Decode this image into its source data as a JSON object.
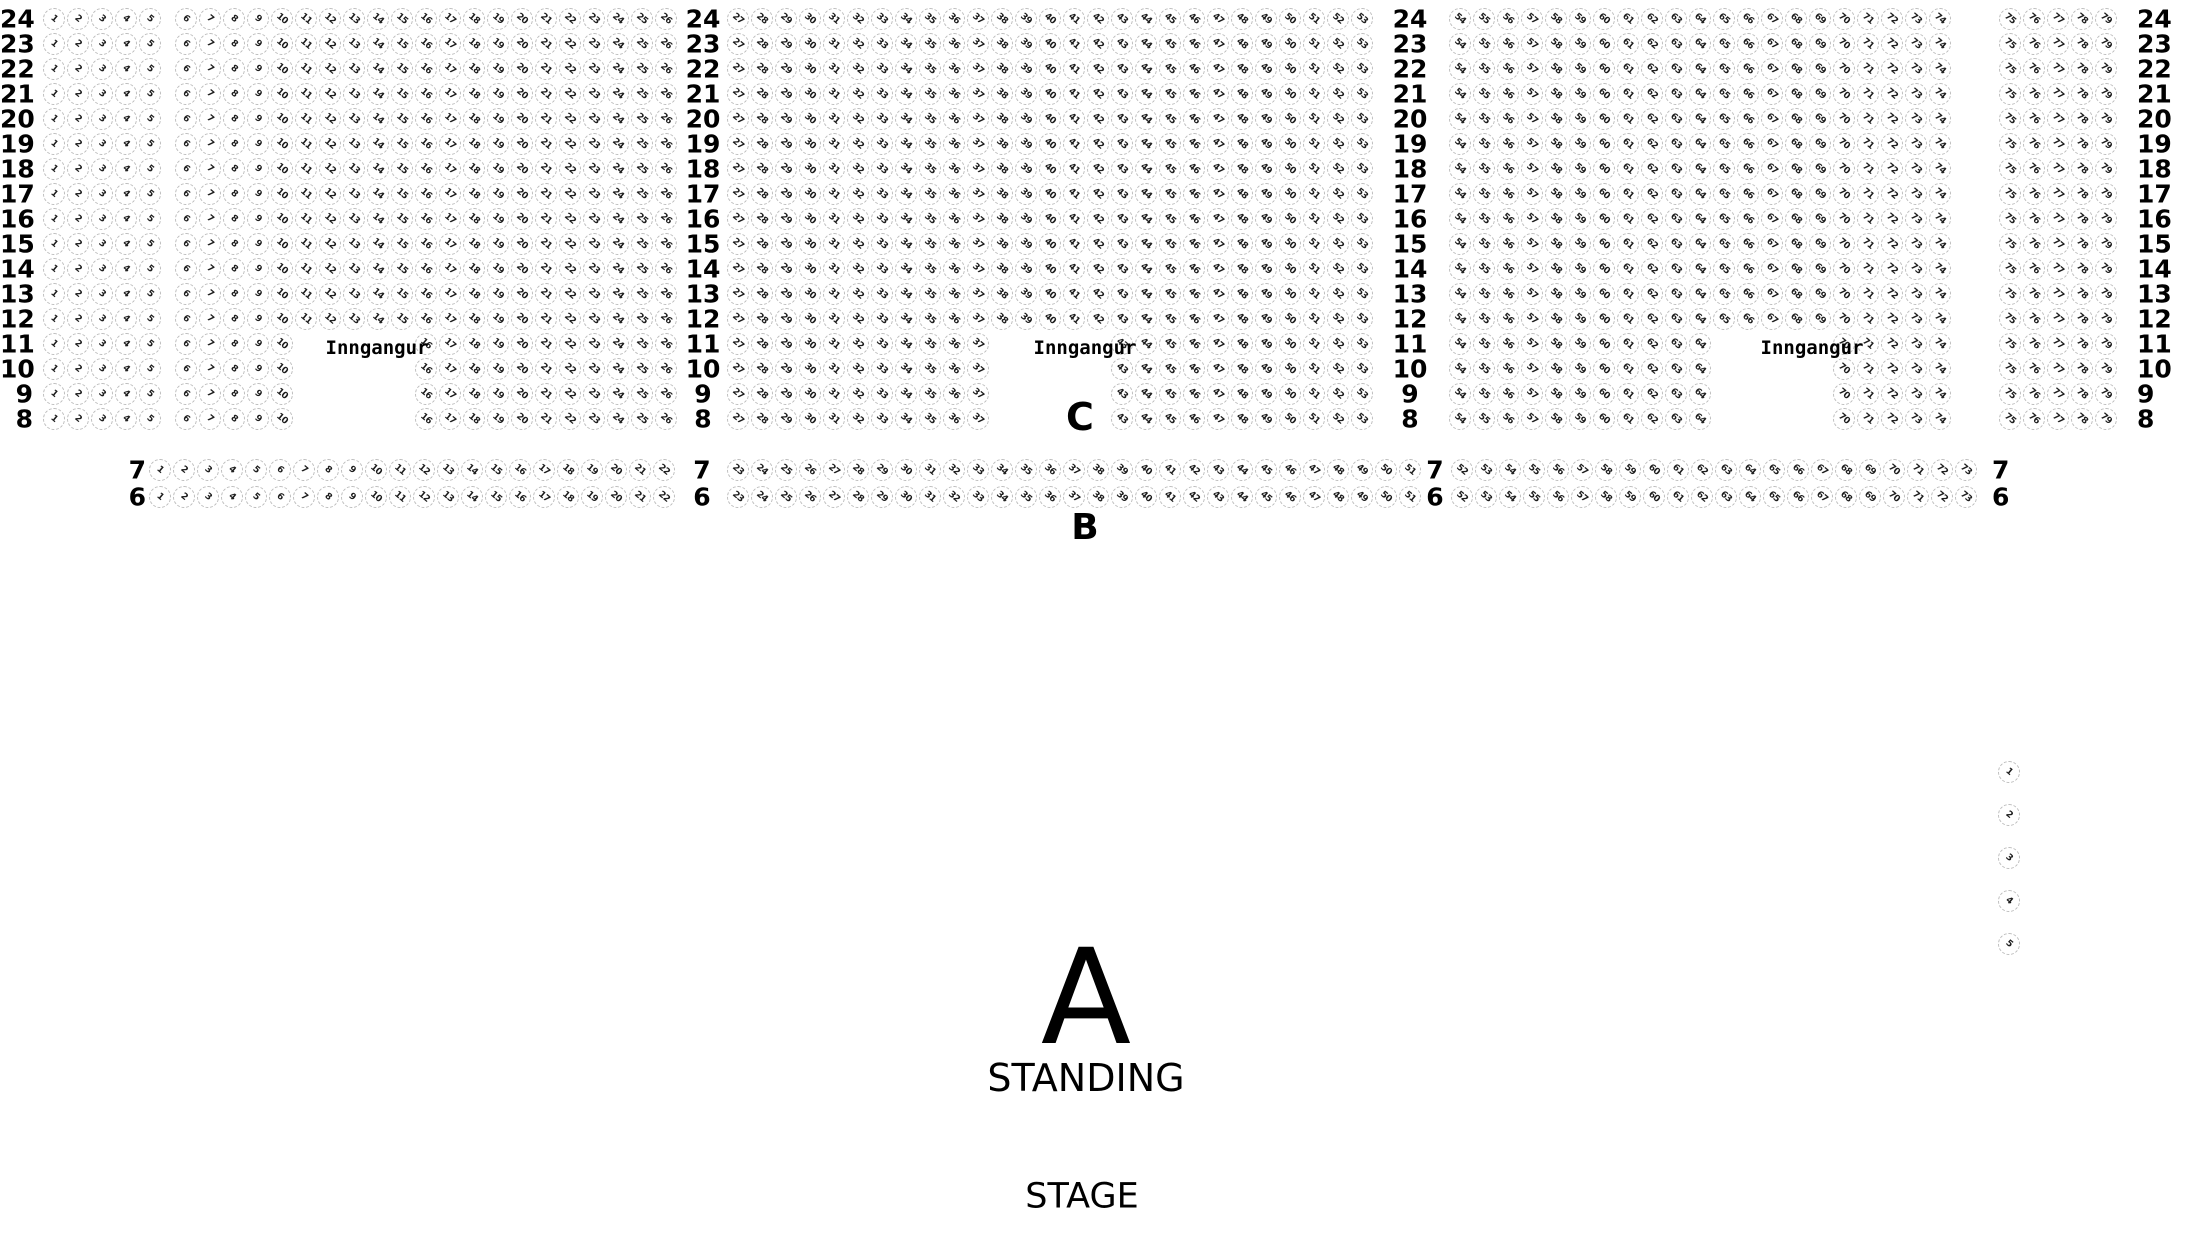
{
  "labels": {
    "entrance": "Inngangur",
    "section_c": "C",
    "section_b": "B",
    "section_a": "A",
    "standing": "STANDING",
    "stage": "STAGE"
  },
  "seat_map": {
    "section_c": {
      "row_order": [
        24,
        23,
        22,
        21,
        20,
        19,
        18,
        17,
        16,
        15,
        14,
        13,
        12,
        11,
        10,
        9,
        8
      ],
      "rows_with_entrance_gap": [
        11,
        10,
        9,
        8
      ],
      "groups_full": [
        [
          1,
          5
        ],
        [
          6,
          26
        ],
        [
          27,
          53
        ],
        [
          54,
          74
        ],
        [
          75,
          79
        ]
      ],
      "groups_entrance": [
        [
          1,
          5
        ],
        [
          6,
          10
        ],
        [
          16,
          26
        ],
        [
          27,
          37
        ],
        [
          43,
          53
        ],
        [
          54,
          64
        ],
        [
          70,
          74
        ],
        [
          75,
          79
        ]
      ]
    },
    "section_b": {
      "row_order": [
        7,
        6
      ],
      "groups": [
        [
          1,
          22
        ],
        [
          23,
          51
        ],
        [
          52,
          73
        ]
      ]
    },
    "side_seats": [
      1,
      2,
      3,
      4,
      5
    ],
    "colors": {
      "seat_border": "#bdbdbd",
      "seat_number": "#1c1c1c",
      "label_text": "#000000",
      "background": "#ffffff"
    }
  }
}
